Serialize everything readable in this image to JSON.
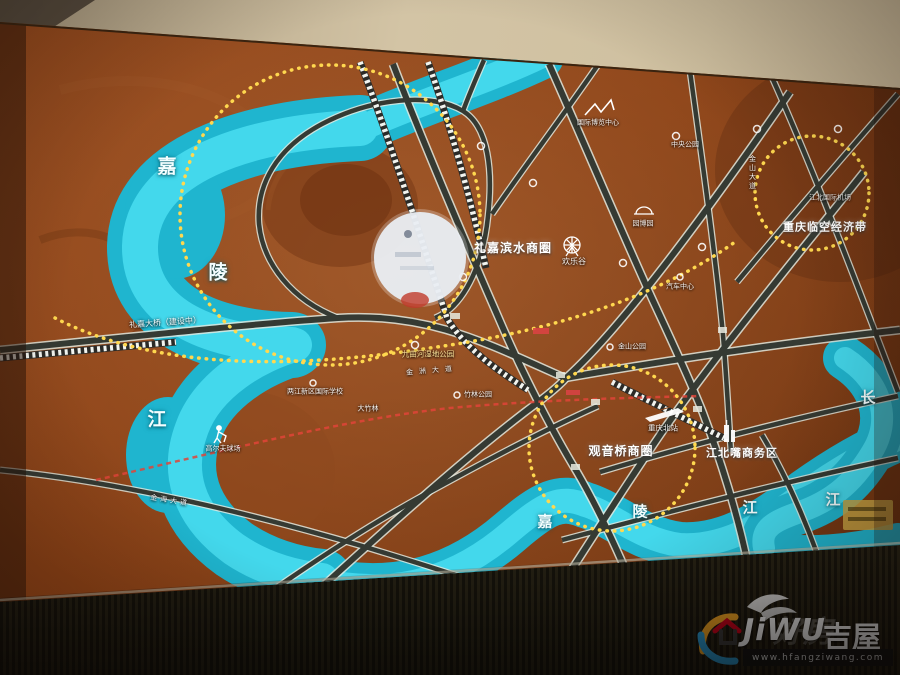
{
  "map": {
    "river_labels": {
      "jia1": "嘉",
      "ling1": "陵",
      "jiang1": "江",
      "jia2": "嘉",
      "ling2": "陵",
      "jiang2": "江",
      "chang": "长",
      "jiang3": "江"
    },
    "bridge_lijia": "礼嘉大桥（建设中）",
    "districts": {
      "lijia_binshui": "礼嘉滨水商圈",
      "guanyinqiao": "观音桥商圈",
      "jiangbeizui": "江北嘴商务区",
      "linkong": "重庆临空经济带"
    },
    "pois": {
      "happy_valley": "欢乐谷",
      "cq_north_station": "重庆北站",
      "airport": "江北国际机场",
      "jiuquhe_park": "九曲河湿地公园",
      "zhulin_park": "竹林公园",
      "dazhulin": "大竹林",
      "intl_school": "两江新区国际学校",
      "golf": "高尔夫球场",
      "jinshan_park": "金山公园",
      "auto_center": "汽车中心",
      "yuanboyuan": "园博园",
      "expo_center": "国际博览中心",
      "central_park": "中央公园"
    },
    "road_labels": {
      "jinzhou": "金洲大道",
      "jinhai": "金海大道",
      "jinshan": "金山大道"
    }
  },
  "watermark": {
    "brand_latin": "JiWU",
    "brand_cn": "吉屋",
    "brand_cn_faint": "好房",
    "url": "www.hfangziwang.com"
  },
  "colors": {
    "river": "#2fc8de",
    "board_brown": "#8a4519",
    "highlight_yellow": "#ffd84f",
    "metro_red": "#e04438"
  }
}
